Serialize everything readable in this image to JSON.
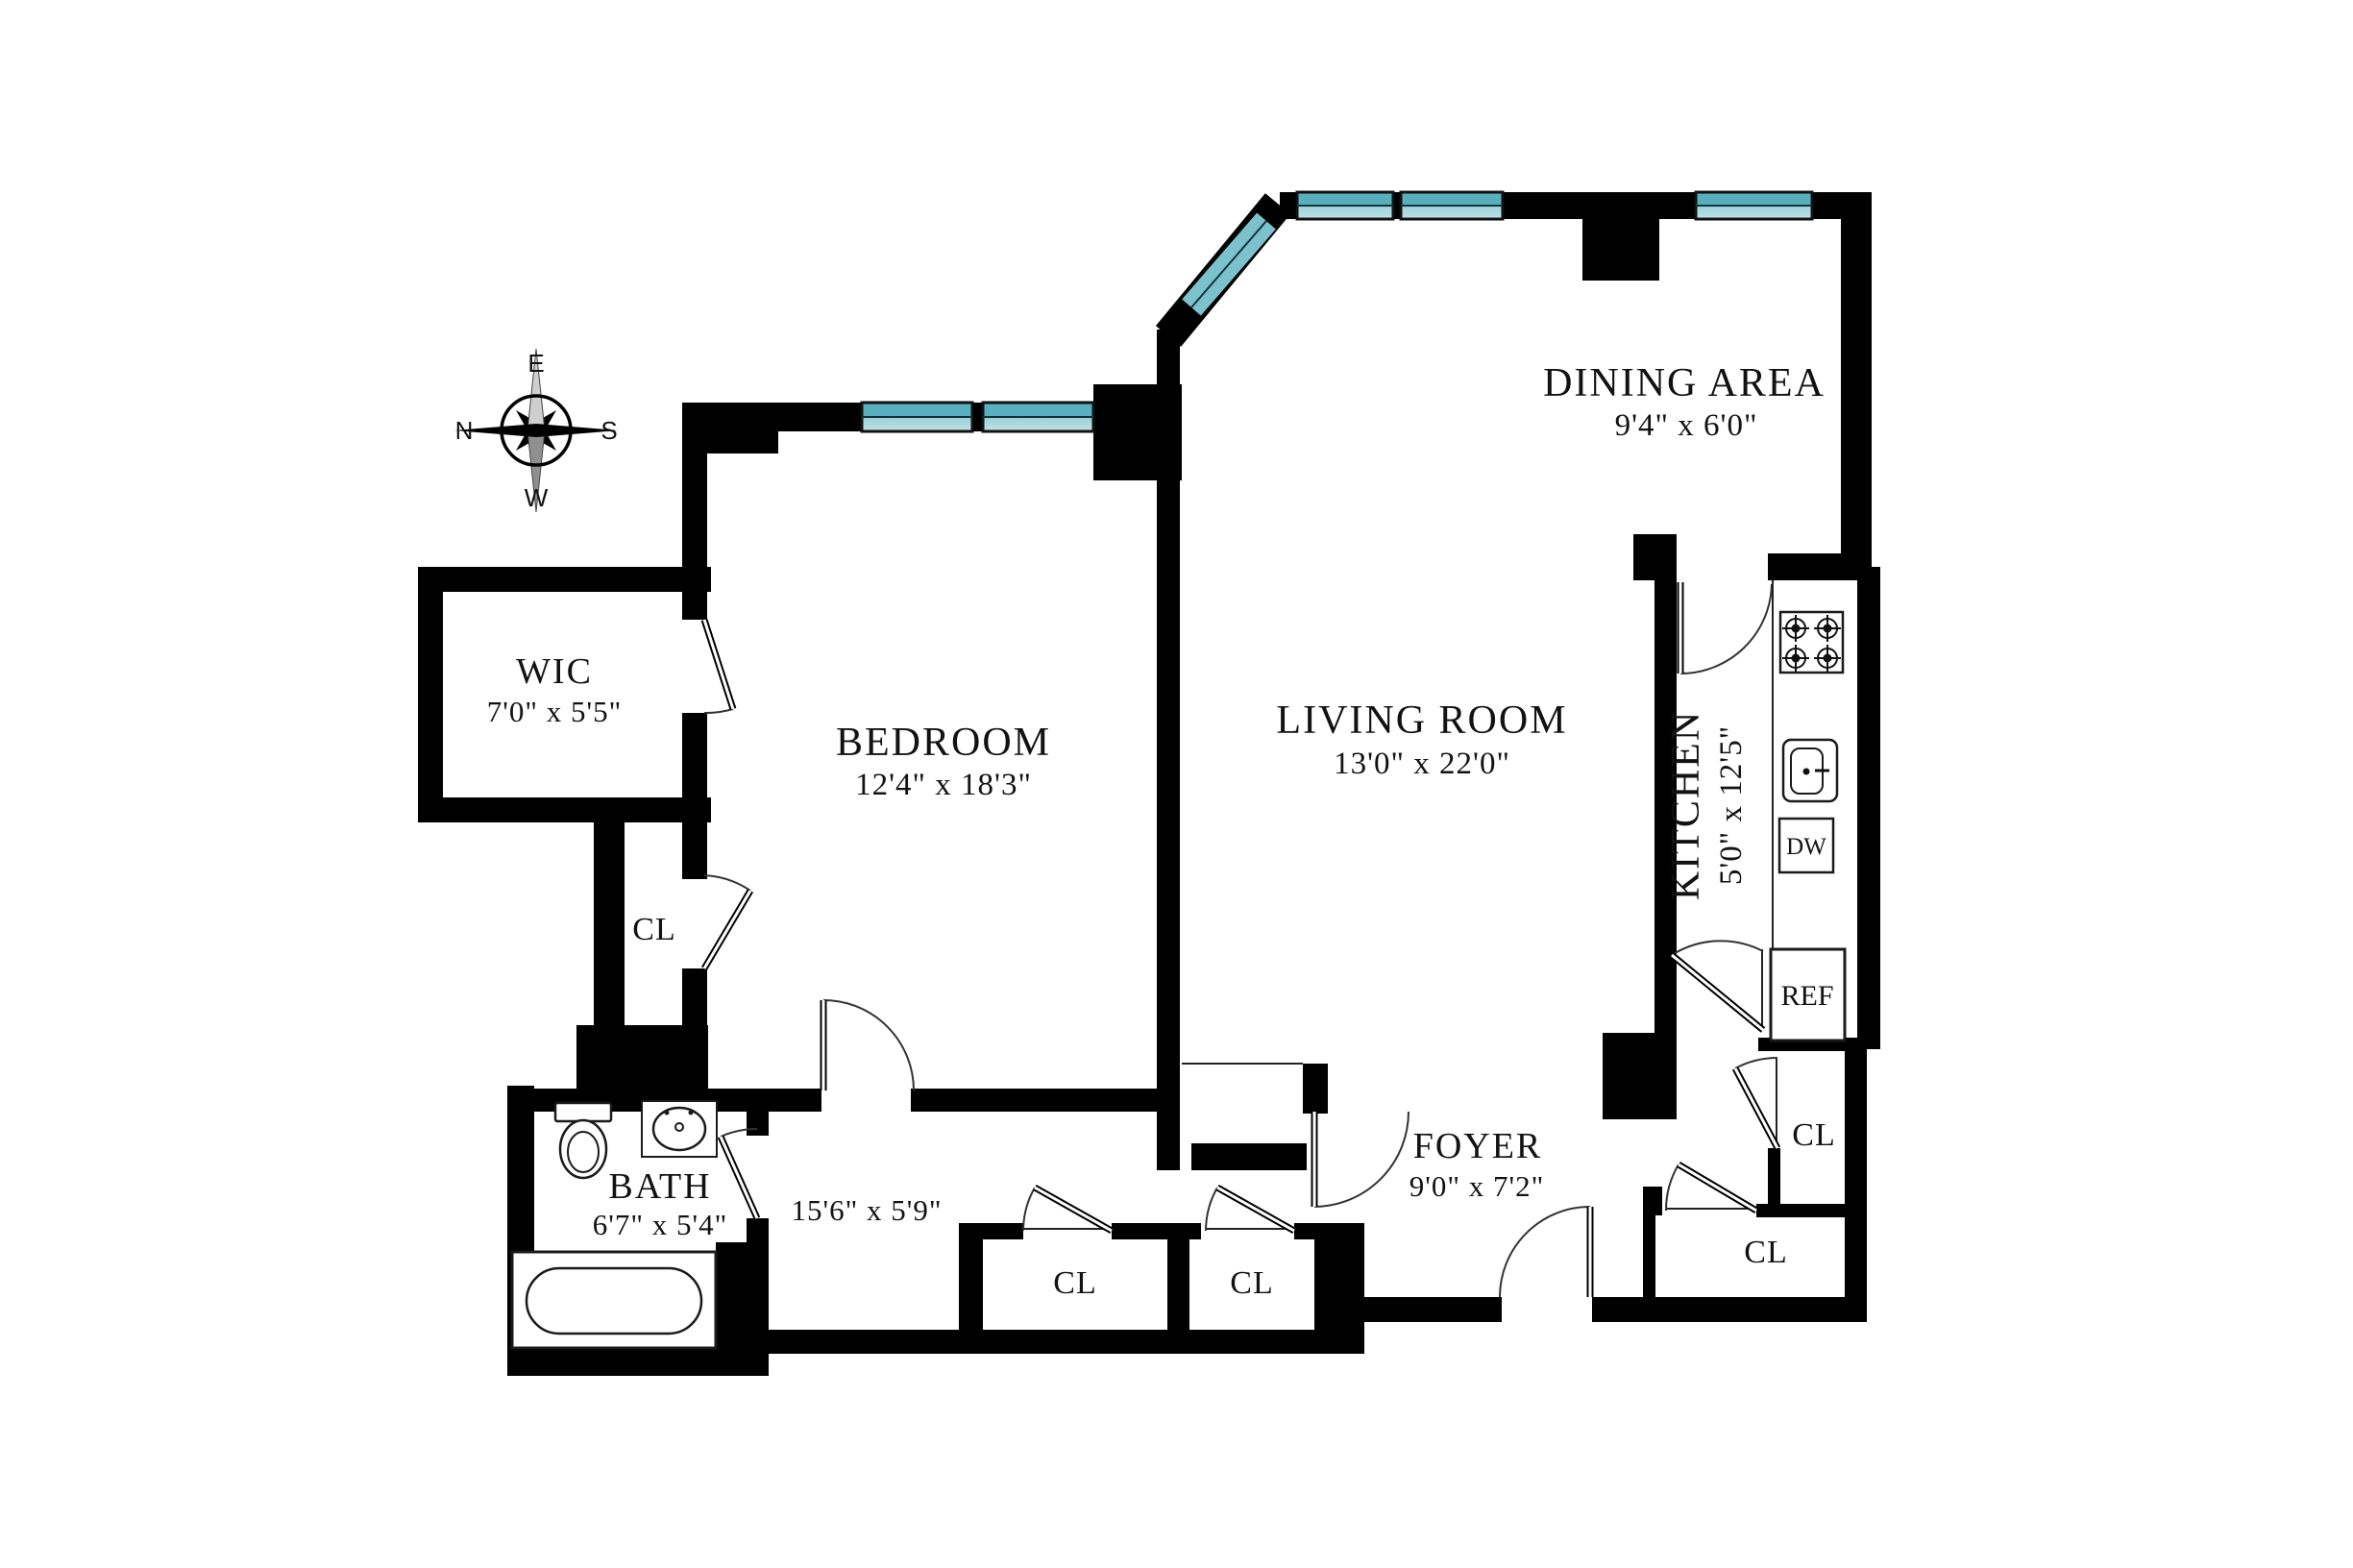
{
  "plan": {
    "rooms": [
      {
        "name": "WIC",
        "dims": "7'0\" x 5'5\""
      },
      {
        "name": "BEDROOM",
        "dims": "12'4\" x 18'3\""
      },
      {
        "name": "LIVING ROOM",
        "dims": "13'0\" x 22'0\""
      },
      {
        "name": "DINING AREA",
        "dims": "9'4\" x 6'0\""
      },
      {
        "name": "KITCHEN",
        "dims": "5'0\" x 12'5\""
      },
      {
        "name": "BATH",
        "dims": "6'7\" x 5'4\""
      },
      {
        "name": "FOYER",
        "dims": "9'0\" x 7'2\""
      },
      {
        "name": "HALLWAY",
        "dims": "15'6\" x 5'9\""
      }
    ],
    "closet_label": "CL",
    "appliances": {
      "dishwasher": "DW",
      "refrigerator": "REF"
    },
    "compass": {
      "north": "N",
      "south": "S",
      "east": "E",
      "west": "W"
    },
    "colors": {
      "wall": "#000000",
      "window_top": "#58b0bf",
      "window_bottom": "#c2e3e8",
      "window_diag": "#7cc2cc"
    }
  }
}
